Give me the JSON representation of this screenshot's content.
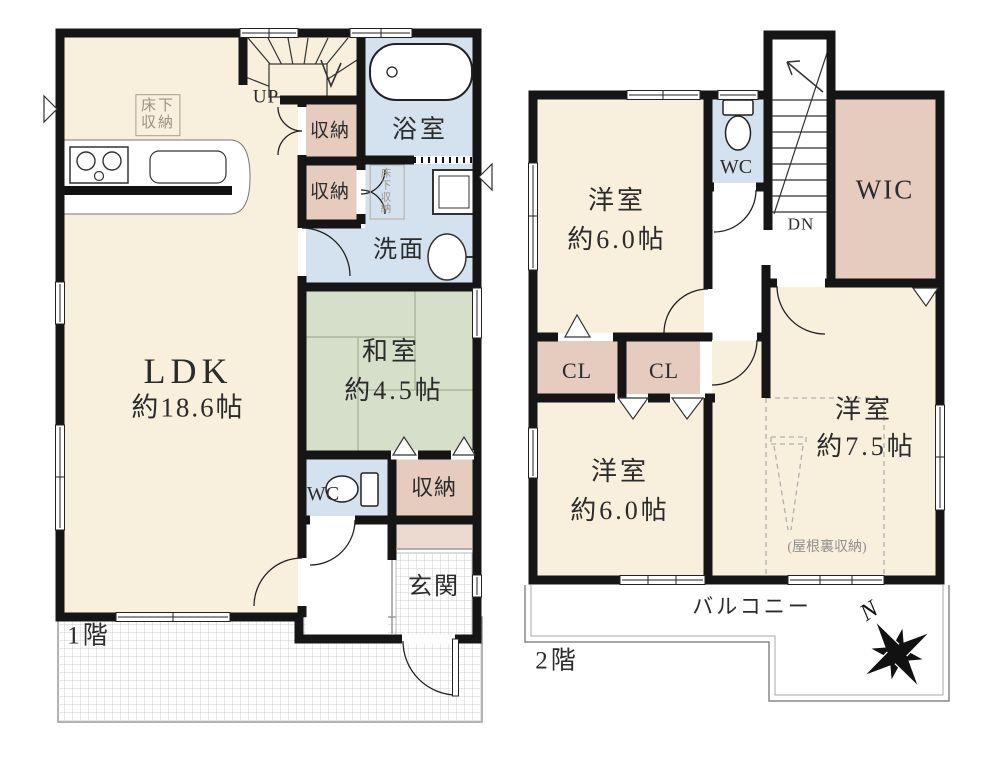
{
  "document_type": "floor-plan",
  "colors": {
    "wall": "#151515",
    "room_cream": "#f8efdc",
    "tatami_green": "#d5dfca",
    "water_blue": "#d3e2ee",
    "closet_pink": "#e5ccbe",
    "shoe_cabinet_pink": "#ecd9cf",
    "tile_grid_line": "#cfcfcf",
    "dashed_gray": "#b0b0b0"
  },
  "floor1": {
    "label": "1階",
    "stairs": {
      "label": "UP"
    },
    "rooms": {
      "ldk": {
        "name": "LDK",
        "size": "約18.6帖"
      },
      "washitsu": {
        "name": "和室",
        "size": "約4.5帖"
      },
      "bath": {
        "name": "浴室"
      },
      "washroom": {
        "name": "洗面"
      },
      "wc": {
        "name": "WC"
      },
      "storage1": {
        "name": "収納"
      },
      "storage2": {
        "name": "収納"
      },
      "storage3": {
        "name": "収納"
      },
      "underfloor_storage1": {
        "name": "床下収納"
      },
      "underfloor_storage2": {
        "name": "床下収納"
      },
      "entrance": {
        "name": "玄関"
      }
    }
  },
  "floor2": {
    "label": "2階",
    "stairs": {
      "label": "DN"
    },
    "compass": {
      "north": "N"
    },
    "rooms": {
      "bedroom1": {
        "name": "洋室",
        "size": "約6.0帖"
      },
      "bedroom2": {
        "name": "洋室",
        "size": "約6.0帖"
      },
      "bedroom3": {
        "name": "洋室",
        "size": "約7.5帖"
      },
      "wic": {
        "name": "WIC"
      },
      "wc": {
        "name": "WC"
      },
      "closet1": {
        "name": "CL"
      },
      "closet2": {
        "name": "CL"
      },
      "attic_storage": {
        "name": "(屋根裏収納)"
      },
      "balcony": {
        "name": "バルコニー"
      }
    }
  }
}
